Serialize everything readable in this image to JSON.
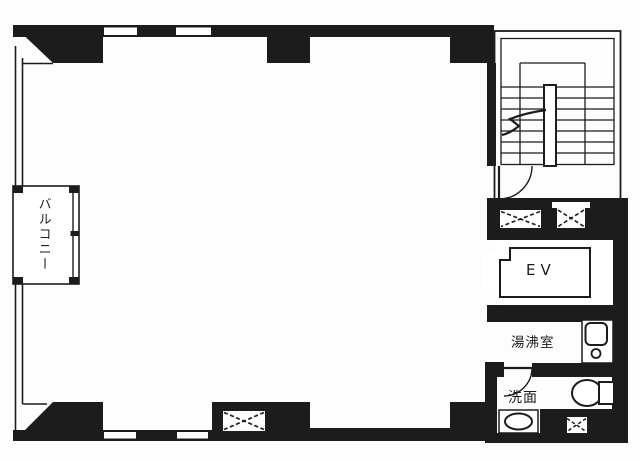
{
  "plan": {
    "title_hint": "floor-plan",
    "labels": {
      "balcony": "バルコニー",
      "elevator": "EV",
      "kitchenette": "湯沸室",
      "washroom": "洗面"
    },
    "colors": {
      "ink": "#1c1c1c",
      "paper": "#fdfdfd"
    }
  }
}
